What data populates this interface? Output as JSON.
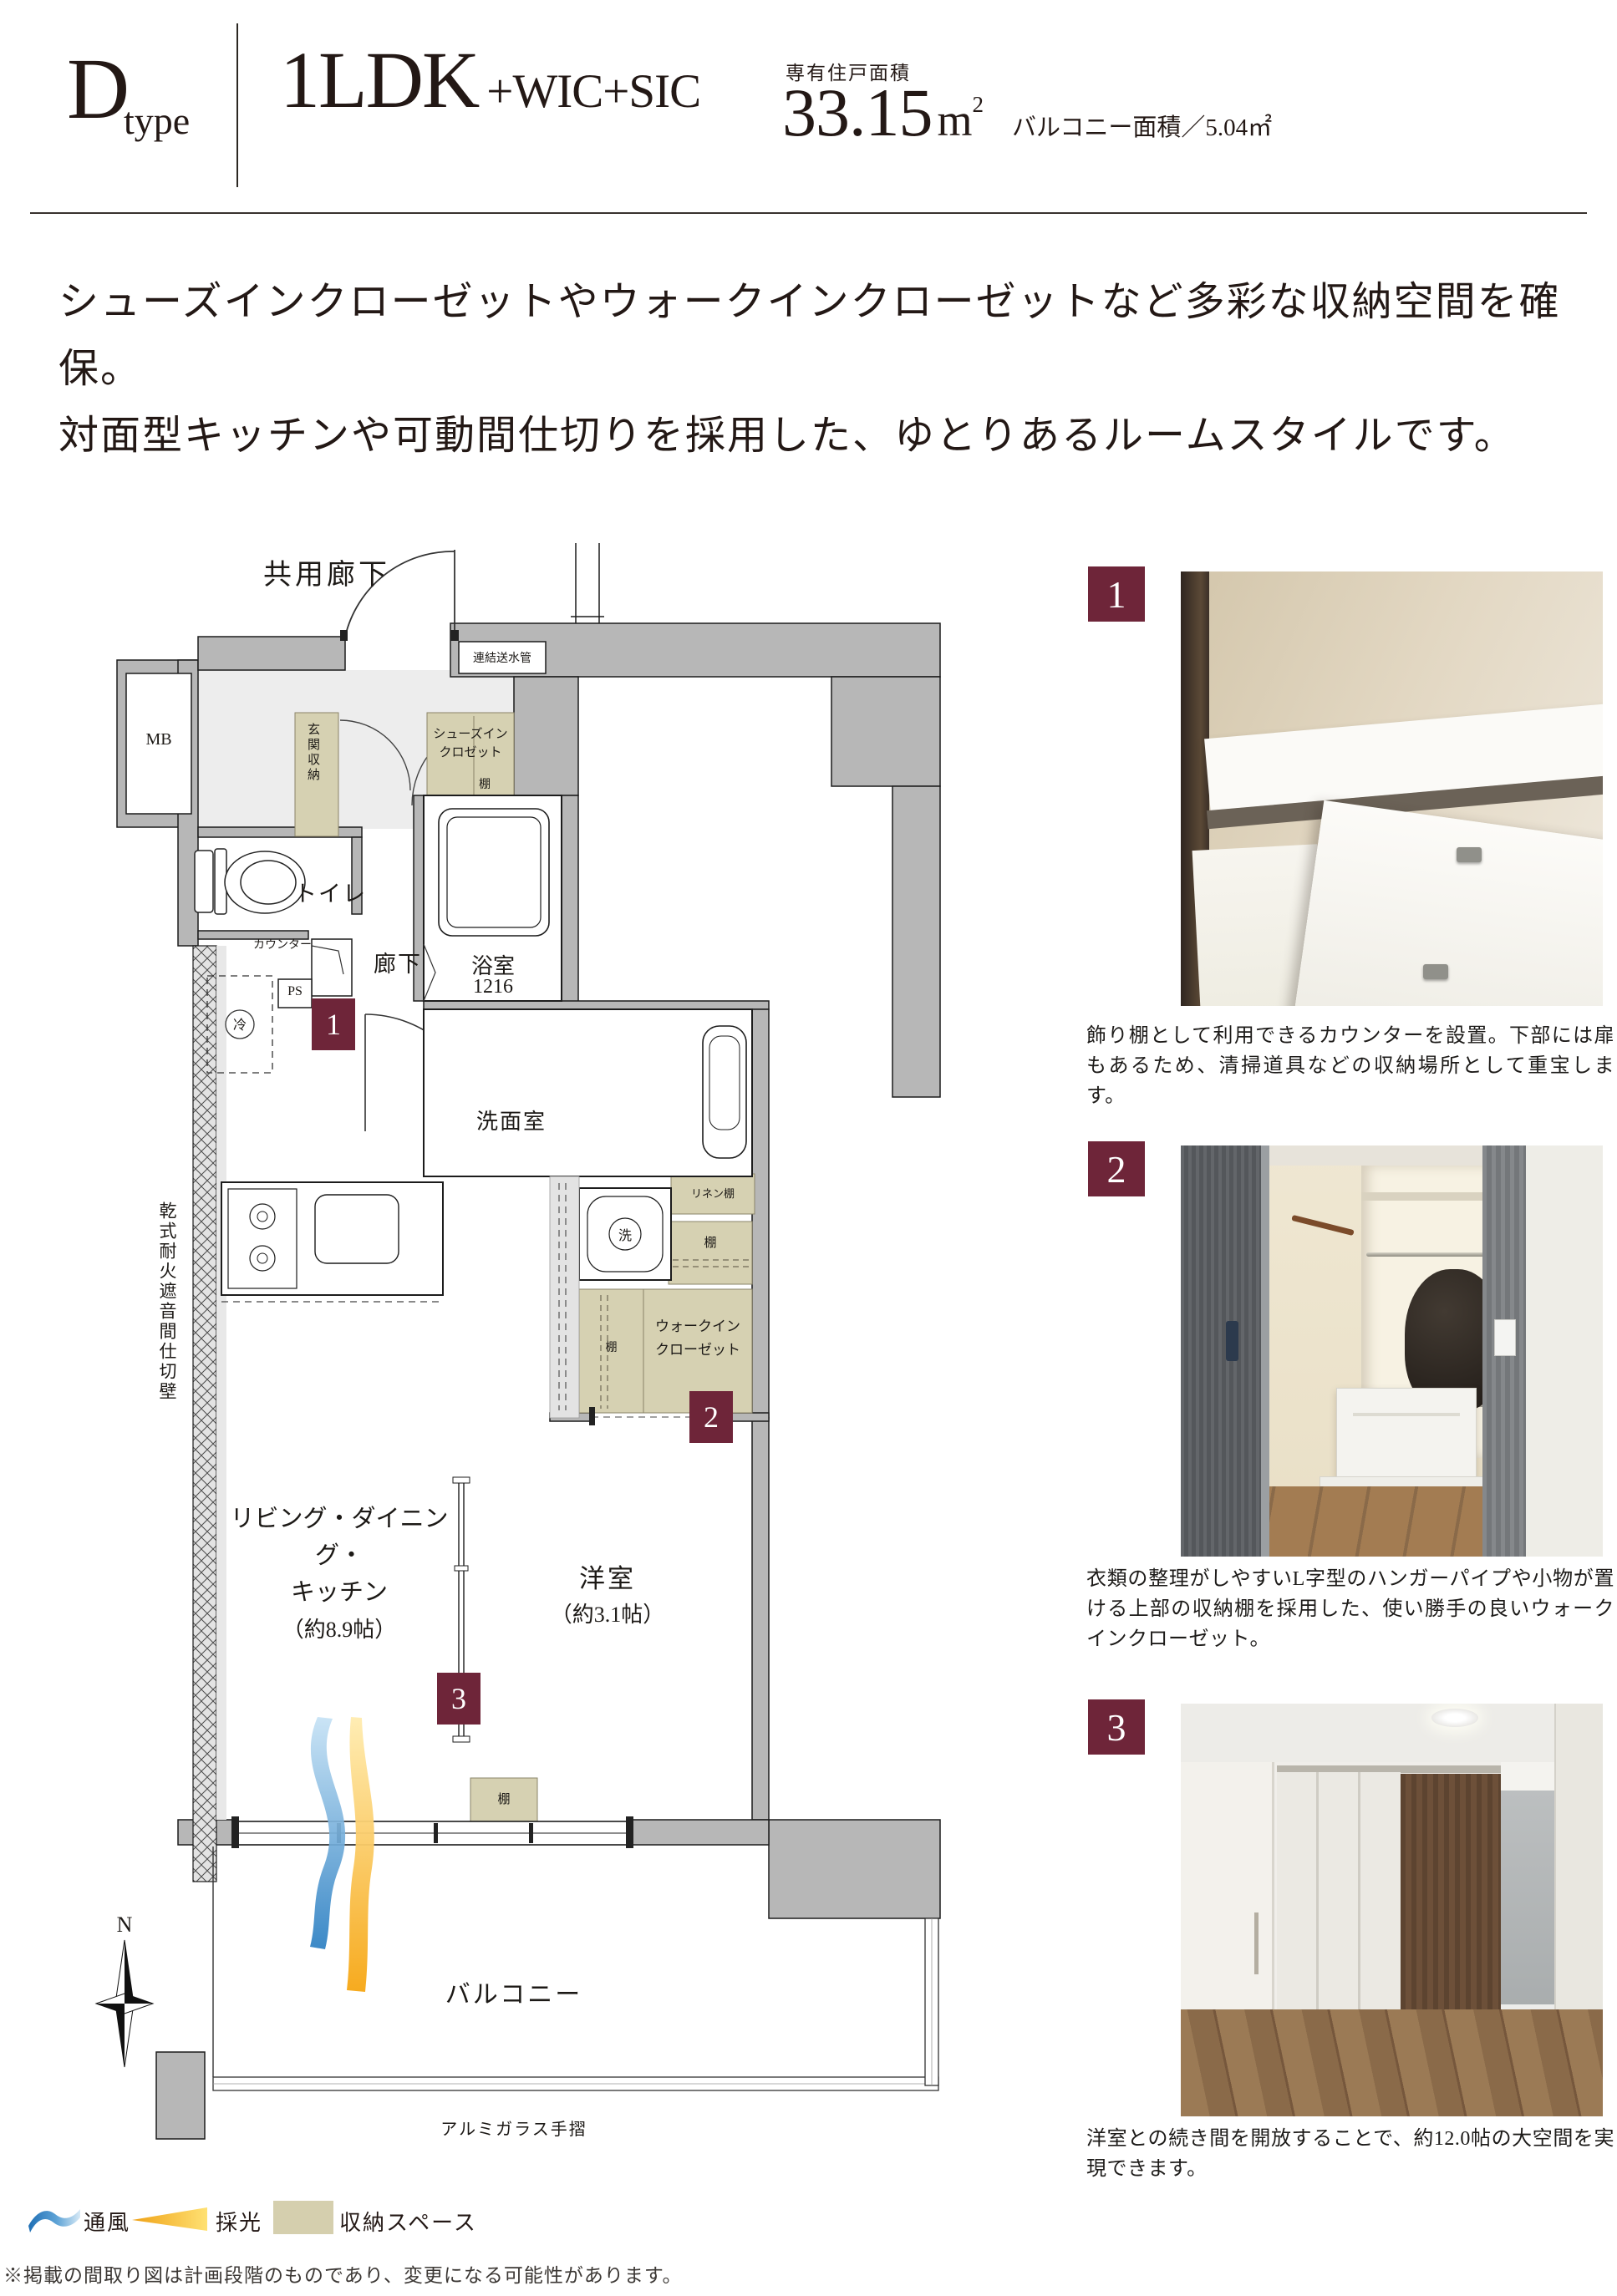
{
  "header": {
    "type_letter": "D",
    "type_word": "type",
    "plan_main": "1LDK",
    "plan_extra": "+WIC+SIC",
    "area_caption": "専有住戸面積",
    "area_value": "33.15",
    "area_unit_base": "m",
    "area_unit_sup": "2",
    "balcony_note": "バルコニー面積／5.04㎡"
  },
  "description": {
    "line1": "シューズインクローゼットやウォークインクローゼットなど多彩な収納空間を確保。",
    "line2": "対面型キッチンや可動間仕切りを採用した、ゆとりあるルームスタイルです。"
  },
  "floorplan": {
    "common_corridor": "共用廊下",
    "standpipe": "連結送水管",
    "meter_box": "MB",
    "entrance_storage": "玄関収納",
    "shoes_closet_1": "シューズイン",
    "shoes_closet_2": "クロゼット",
    "shelf": "棚",
    "toilet": "トイレ",
    "counter": "カウンター",
    "pipe_space": "PS",
    "refrigerator": "冷",
    "hallway": "廊下",
    "bathroom": "浴室",
    "bathroom_size": "1216",
    "washroom": "洗面室",
    "linen_shelf": "リネン棚",
    "washer": "洗",
    "walk_in_1": "ウォークイン",
    "walk_in_2": "クローゼット",
    "ldk_1": "リビング・ダイニング・",
    "ldk_2": "キッチン",
    "ldk_3": "（約8.9帖）",
    "western_room": "洋室",
    "western_room_size": "（約3.1帖）",
    "balcony": "バルコニー",
    "handrail": "アルミガラス手摺",
    "partition_wall": "乾式耐火遮音間仕切壁",
    "compass_north": "N",
    "badge_1": "1",
    "badge_2": "2",
    "badge_3": "3"
  },
  "photos": [
    {
      "badge": "1",
      "caption": "飾り棚として利用できるカウンターを設置。下部には扉もあるため、清掃道具などの収納場所として重宝します。"
    },
    {
      "badge": "2",
      "caption": "衣類の整理がしやすいL字型のハンガーパイプや小物が置ける上部の収納棚を採用した、使い勝手の良いウォークインクローゼット。"
    },
    {
      "badge": "3",
      "caption": "洋室との続き間を開放することで、約12.0帖の大空間を実現できます。"
    }
  ],
  "legend": {
    "ventilation": "通風",
    "daylight": "採光",
    "storage": "収納スペース"
  },
  "footnote": "※掲載の間取り図は計画段階のものであり、変更になる可能性があります。",
  "colors": {
    "accent": "#6e2539",
    "storage_fill": "#d6d1b2",
    "wall_fill": "#b7b7b7",
    "ink": "#231815",
    "vent_blue": "#2b7fc2",
    "daylight_yellow": "#f6a613"
  }
}
